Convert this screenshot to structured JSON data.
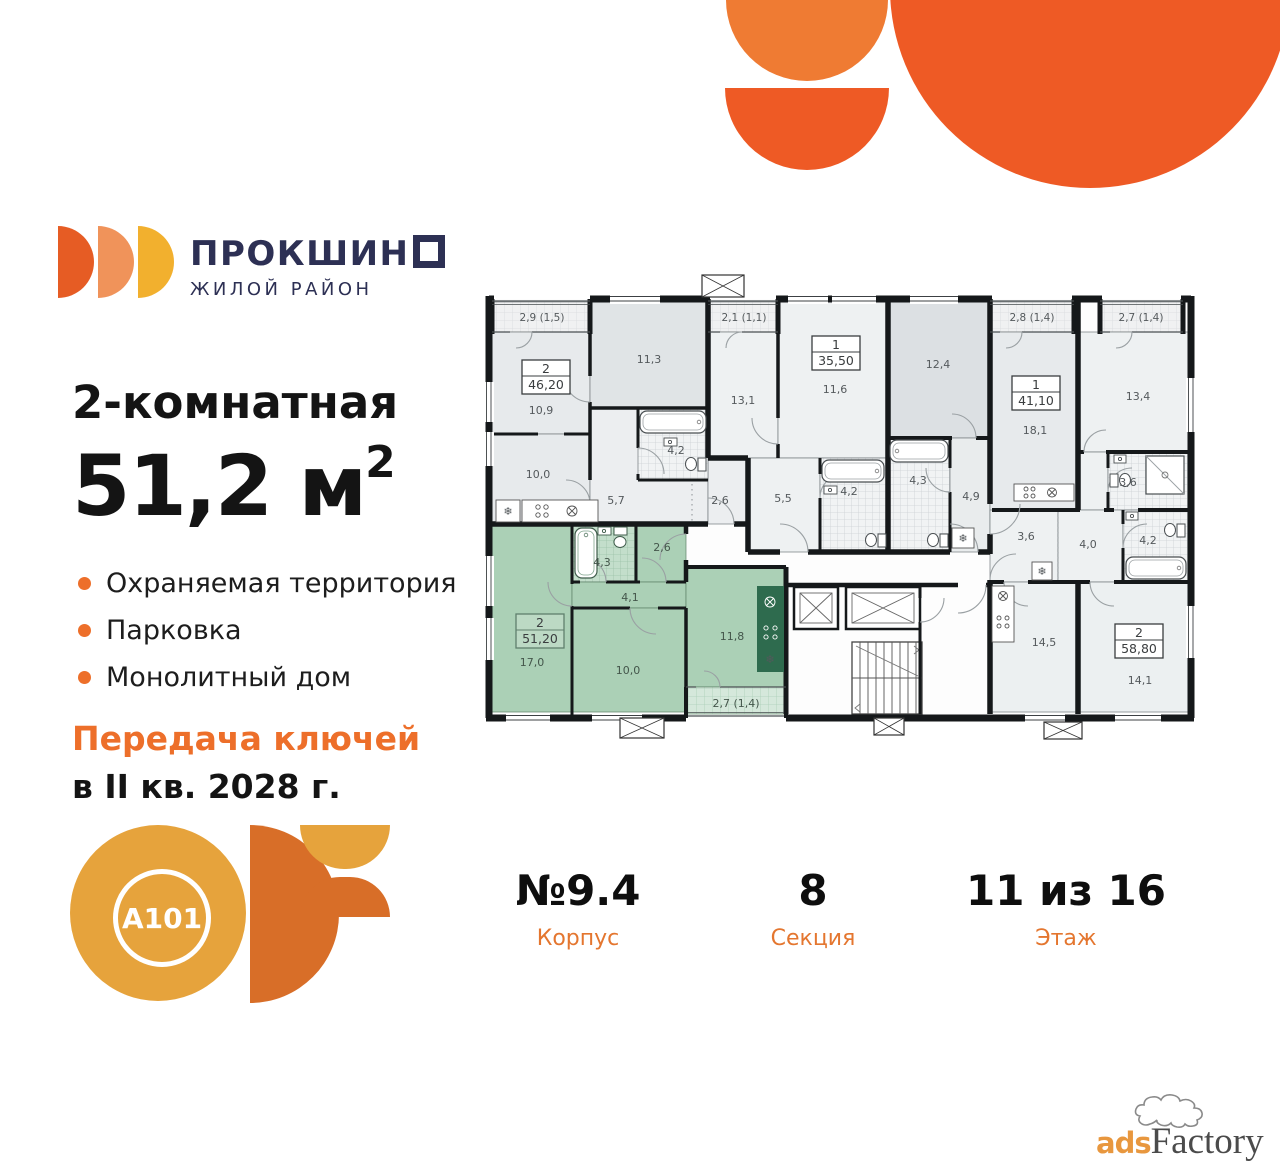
{
  "brand": {
    "name_main": "ПРОКШИН",
    "name_last_square": "",
    "subtitle": "ЖИЛОЙ РАЙОН"
  },
  "listing": {
    "title": "2-комнатная",
    "area_value": "51,2 м",
    "area_sup": "2",
    "features": [
      "Охраняемая территория",
      "Парковка",
      "Монолитный дом"
    ],
    "handover_line1": "Передача ключей",
    "handover_line2": "в II кв. 2028 г."
  },
  "specs": {
    "items": [
      {
        "value": "№9.4",
        "label": "Корпус"
      },
      {
        "value": "8",
        "label": "Секция"
      },
      {
        "value": "11 из 16",
        "label": "Этаж"
      }
    ]
  },
  "developer": {
    "logo_text": "A101"
  },
  "watermark": {
    "ads": "ads",
    "factory": "Factory"
  },
  "colors": {
    "accent_orange": "#ed6f2a",
    "deco_orange": "#ee5a25",
    "deco_orange_light": "#ef7b33",
    "brand_navy": "#2d3054",
    "gold": "#e6a33c",
    "highlight_green": "#abd0b6"
  },
  "floor_plan": {
    "highlighted_apartment_index": 4,
    "apartment_tags": [
      {
        "rooms": "2",
        "area": "46,20"
      },
      {
        "rooms": "1",
        "area": "35,50"
      },
      {
        "rooms": "1",
        "area": "41,10"
      },
      {
        "rooms": "2",
        "area": "58,80"
      },
      {
        "rooms": "2",
        "area": "51,20"
      }
    ],
    "room_labels": [
      "2,9 (1,5)",
      "10,9",
      "11,3",
      "2,1 (1,1)",
      "13,1",
      "11,6",
      "12,4",
      "2,8 (1,4)",
      "18,1",
      "2,7 (1,4)",
      "13,4",
      "4,2",
      "10,0",
      "5,7",
      "2,6",
      "5,5",
      "4,2",
      "4,3",
      "4,9",
      "3,6",
      "3,6",
      "4,0",
      "4,2",
      "14,5",
      "14,1",
      "4,3",
      "2,6",
      "4,1",
      "17,0",
      "10,0",
      "11,8",
      "2,7 (1,4)"
    ]
  }
}
